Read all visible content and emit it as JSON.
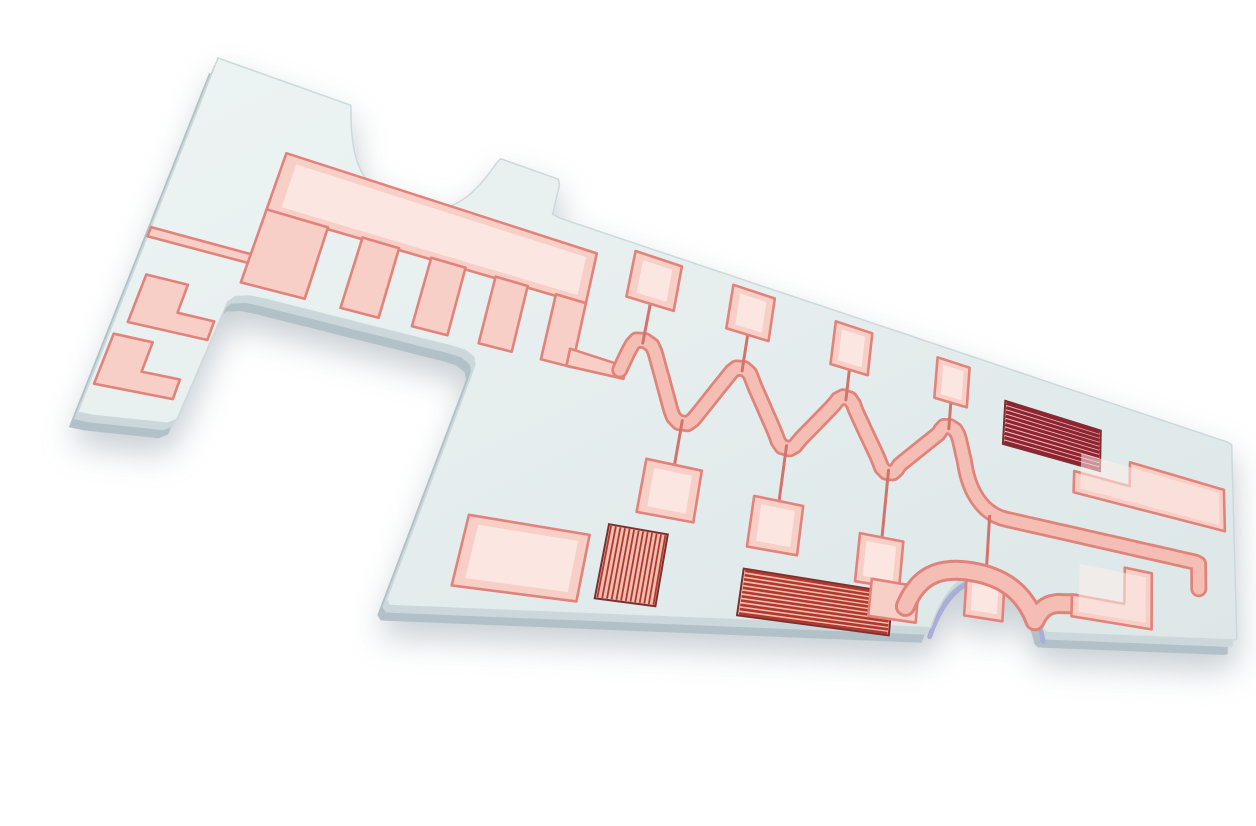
{
  "scene": {
    "kind": "photograph",
    "subject": "ceramic-microwave-circuit-substrate",
    "background": "#ffffff",
    "canvas": {
      "width": 1256,
      "height": 794
    }
  },
  "palette": {
    "face_light": "#eef4f4",
    "face_dark": "#dde7e8",
    "face_stroke": "#ccd9db",
    "edge_dark": "#b2c1c8",
    "edge_mid": "#cbd7da",
    "edge_lavender": "#a9aed8",
    "copper_fill": "#f7cfc7",
    "copper_fill_light": "#fdeee9",
    "copper_edge": "#e2837b",
    "stub": "#d4736c",
    "wave_outer": "#e0837a",
    "wave_inner": "#f5beb5",
    "stripe_red": "#b0392b",
    "stripe_dark": "#8e2433",
    "stripe_bg": "#f0bdb3",
    "stripe_frame": "#7b3031"
  },
  "projection": {
    "comment": "board-space (X,Y) to image px; w = 1 + kx*X + ky*Y; x=(ax*X+ay*Y+tx)/w; y=(bx*X+by*Y+ty)/w",
    "kx": 0.00086637,
    "ky": -0.0003322,
    "ax": 2.0448,
    "ay": -0.37161,
    "tx": 178,
    "bx": 0.7101,
    "by": 0.77536,
    "ty": 42
  },
  "board": {
    "outline_d": "M0,0 L75,0 C85,72 97,96 123,96 C149,96 161,64 171,0 L215,0 L215,50 L1000,50 L1000,420 L718,457 C706,398 684,376 652,378 C620,380 598,420 588,474 L173,528 L189,261 Q190,243 175,243 L62,243 Q47,243 47,258 L43,385 L0,392 Z",
    "bottom_bite_d": "M718,457 C706,398 684,376 652,378 C620,380 598,420 588,474",
    "edge_offsets": [
      {
        "dx": -9,
        "dy": 15,
        "color": "edge_dark"
      },
      {
        "dx": -4,
        "dy": 7,
        "color": "edge_mid"
      }
    ]
  },
  "features": [
    {
      "name": "feed-trace",
      "type": "poly",
      "pts": [
        [
          0,
          200
        ],
        [
          58,
          200
        ],
        [
          70,
          194
        ],
        [
          84,
          194
        ],
        [
          84,
          226
        ],
        [
          70,
          218
        ],
        [
          58,
          210
        ],
        [
          0,
          210
        ]
      ]
    },
    {
      "name": "comb-pad",
      "type": "rect",
      "x": 50,
      "y": 80,
      "w": 202,
      "h": 70,
      "hl": true
    },
    {
      "name": "comb-tooth-1",
      "type": "rect",
      "x": 50,
      "y": 148,
      "w": 34,
      "h": 84
    },
    {
      "name": "comb-tooth-2",
      "type": "rect",
      "x": 104,
      "y": 148,
      "w": 22,
      "h": 84
    },
    {
      "name": "comb-tooth-3",
      "type": "rect",
      "x": 146,
      "y": 148,
      "w": 22,
      "h": 84
    },
    {
      "name": "comb-tooth-4",
      "type": "rect",
      "x": 188,
      "y": 148,
      "w": 22,
      "h": 84
    },
    {
      "name": "comb-tooth-5",
      "type": "rect",
      "x": 230,
      "y": 148,
      "w": 22,
      "h": 84
    },
    {
      "name": "comb-exit-bar",
      "type": "poly",
      "pts": [
        [
          248,
          210
        ],
        [
          290,
          214
        ],
        [
          290,
          230
        ],
        [
          248,
          232
        ]
      ]
    },
    {
      "name": "meander-line",
      "type": "stroke-path",
      "outer": 17,
      "inner": 11.5,
      "d": "M286,220 C292,174 293,174 299,174 C305,174 307,177 311,190 L329,252 C333,265 335,268 340,268 C345,268 347,265 351,252 L371,190 C375,177 377,174 382,174 C387,174 389,177 393,190 L419,252 C423,265 425,268 430,268 C435,268 437,265 441,252 L469,190 C473,177 475,174 480,174 C485,174 487,177 491,190 L519,252 C523,265 525,268 530,268 C535,268 537,265 541,252 L580,190 C584,177 586,174 591,174 C597,174 600,176 604,190 L612,224 C618,262 634,294 662,296 L938,296 L938,342"
    },
    {
      "name": "stub-top-1",
      "type": "line",
      "pts": [
        [
          299,
          124
        ],
        [
          299,
          178
        ]
      ]
    },
    {
      "name": "stub-top-2",
      "type": "line",
      "pts": [
        [
          382,
          126
        ],
        [
          382,
          178
        ]
      ]
    },
    {
      "name": "stub-top-3",
      "type": "line",
      "pts": [
        [
          480,
          132
        ],
        [
          480,
          178
        ]
      ]
    },
    {
      "name": "stub-top-4",
      "type": "line",
      "pts": [
        [
          591,
          136
        ],
        [
          591,
          178
        ]
      ]
    },
    {
      "name": "stub-bottom-1",
      "type": "line",
      "pts": [
        [
          340,
          322
        ],
        [
          340,
          264
        ]
      ]
    },
    {
      "name": "stub-bottom-2",
      "type": "line",
      "pts": [
        [
          430,
          340
        ],
        [
          430,
          264
        ]
      ]
    },
    {
      "name": "stub-bottom-3",
      "type": "line",
      "pts": [
        [
          530,
          361
        ],
        [
          530,
          264
        ]
      ]
    },
    {
      "name": "stub-bottom-4",
      "type": "line",
      "pts": [
        [
          645,
          384
        ],
        [
          645,
          297
        ]
      ]
    },
    {
      "name": "square-pad-top-1",
      "type": "rect",
      "x": 280,
      "y": 60,
      "w": 38,
      "h": 64,
      "hl": true
    },
    {
      "name": "square-pad-top-2",
      "type": "rect",
      "x": 363,
      "y": 62,
      "w": 38,
      "h": 64,
      "hl": true
    },
    {
      "name": "square-pad-top-3",
      "type": "rect",
      "x": 461,
      "y": 66,
      "w": 38,
      "h": 66,
      "hl": true
    },
    {
      "name": "square-pad-top-4",
      "type": "rect",
      "x": 572,
      "y": 70,
      "w": 38,
      "h": 66,
      "hl": true
    },
    {
      "name": "square-pad-bottom-1",
      "type": "rect",
      "x": 318,
      "y": 322,
      "w": 44,
      "h": 66,
      "hl": true
    },
    {
      "name": "square-pad-bottom-2",
      "type": "rect",
      "x": 408,
      "y": 340,
      "w": 44,
      "h": 66,
      "hl": true
    },
    {
      "name": "square-pad-bottom-3",
      "type": "rect",
      "x": 508,
      "y": 361,
      "w": 44,
      "h": 66,
      "hl": true
    },
    {
      "name": "square-pad-bottom-4",
      "type": "rect",
      "x": 623,
      "y": 384,
      "w": 44,
      "h": 66,
      "hl": true
    },
    {
      "name": "resistor-diagonal",
      "type": "stripes",
      "x": 656,
      "y": 106,
      "w": 130,
      "h": 72,
      "n": 10,
      "dir": "h",
      "sw": 3.2,
      "dark": true
    },
    {
      "name": "resistor-vertical",
      "type": "stripes",
      "x": 300,
      "y": 408,
      "w": 44,
      "h": 86,
      "n": 13,
      "dir": "v",
      "sw": 1.8
    },
    {
      "name": "resistor-horizontal",
      "type": "stripes",
      "x": 408,
      "y": 434,
      "w": 138,
      "h": 58,
      "n": 11,
      "dir": "h",
      "sw": 2.6
    },
    {
      "name": "l-pad-right-large",
      "type": "poly",
      "pts": [
        [
          750,
          190
        ],
        [
          830,
          190
        ],
        [
          830,
          147
        ],
        [
          984,
          147
        ],
        [
          984,
          226
        ],
        [
          750,
          226
        ]
      ],
      "hl": true
    },
    {
      "name": "pad-bottom-left",
      "type": "rect",
      "x": 208,
      "y": 424,
      "w": 80,
      "h": 76,
      "hl": true
    },
    {
      "name": "l-pad-arm-upper",
      "type": "poly",
      "pts": [
        [
          6,
          248
        ],
        [
          26,
          248
        ],
        [
          26,
          278
        ],
        [
          44,
          278
        ],
        [
          44,
          298
        ],
        [
          6,
          298
        ]
      ]
    },
    {
      "name": "l-pad-arm-lower",
      "type": "poly",
      "pts": [
        [
          2,
          312
        ],
        [
          20,
          312
        ],
        [
          20,
          342
        ],
        [
          38,
          342
        ],
        [
          38,
          362
        ],
        [
          2,
          362
        ]
      ]
    },
    {
      "name": "foot-pad",
      "type": "rect",
      "x": 524,
      "y": 420,
      "w": 48,
      "h": 50
    },
    {
      "name": "curved-bite-trace",
      "type": "stroke-path",
      "outer": 21,
      "inner": 15,
      "d": "M560,450 C570,408 588,390 620,386 C660,382 690,398 706,442 C712,424 720,414 734,410 L756,406"
    },
    {
      "name": "l-pad-bottom-right",
      "type": "poly",
      "pts": [
        [
          752,
          392
        ],
        [
          824,
          392
        ],
        [
          824,
          332
        ],
        [
          864,
          332
        ],
        [
          864,
          426
        ],
        [
          752,
          426
        ]
      ],
      "hl": true
    }
  ]
}
